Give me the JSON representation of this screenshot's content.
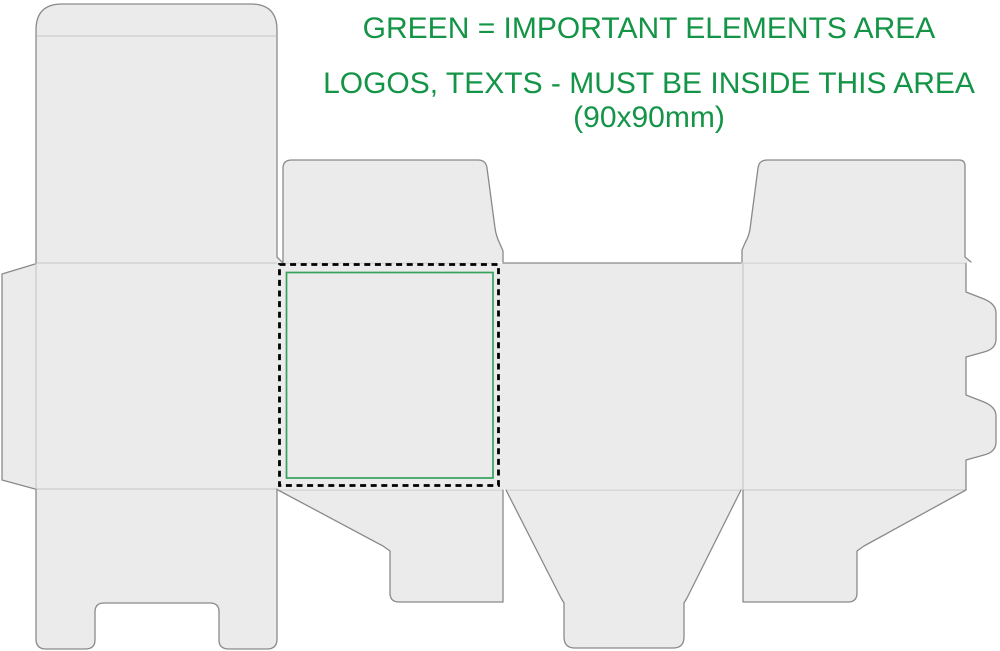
{
  "note": {
    "line1": "GREEN = IMPORTANT ELEMENTS AREA",
    "line2": "LOGOS, TEXTS - MUST BE INSIDE THIS AREA",
    "line3": "(90x90mm)"
  },
  "colors": {
    "background": "#ffffff",
    "panel_fill": "#ebebeb",
    "cut_line": "#8a8a8a",
    "crease_line": "#c6c6c6",
    "dash_color": "#000000",
    "green_border": "#35a15c",
    "green_text": "#149447"
  }
}
